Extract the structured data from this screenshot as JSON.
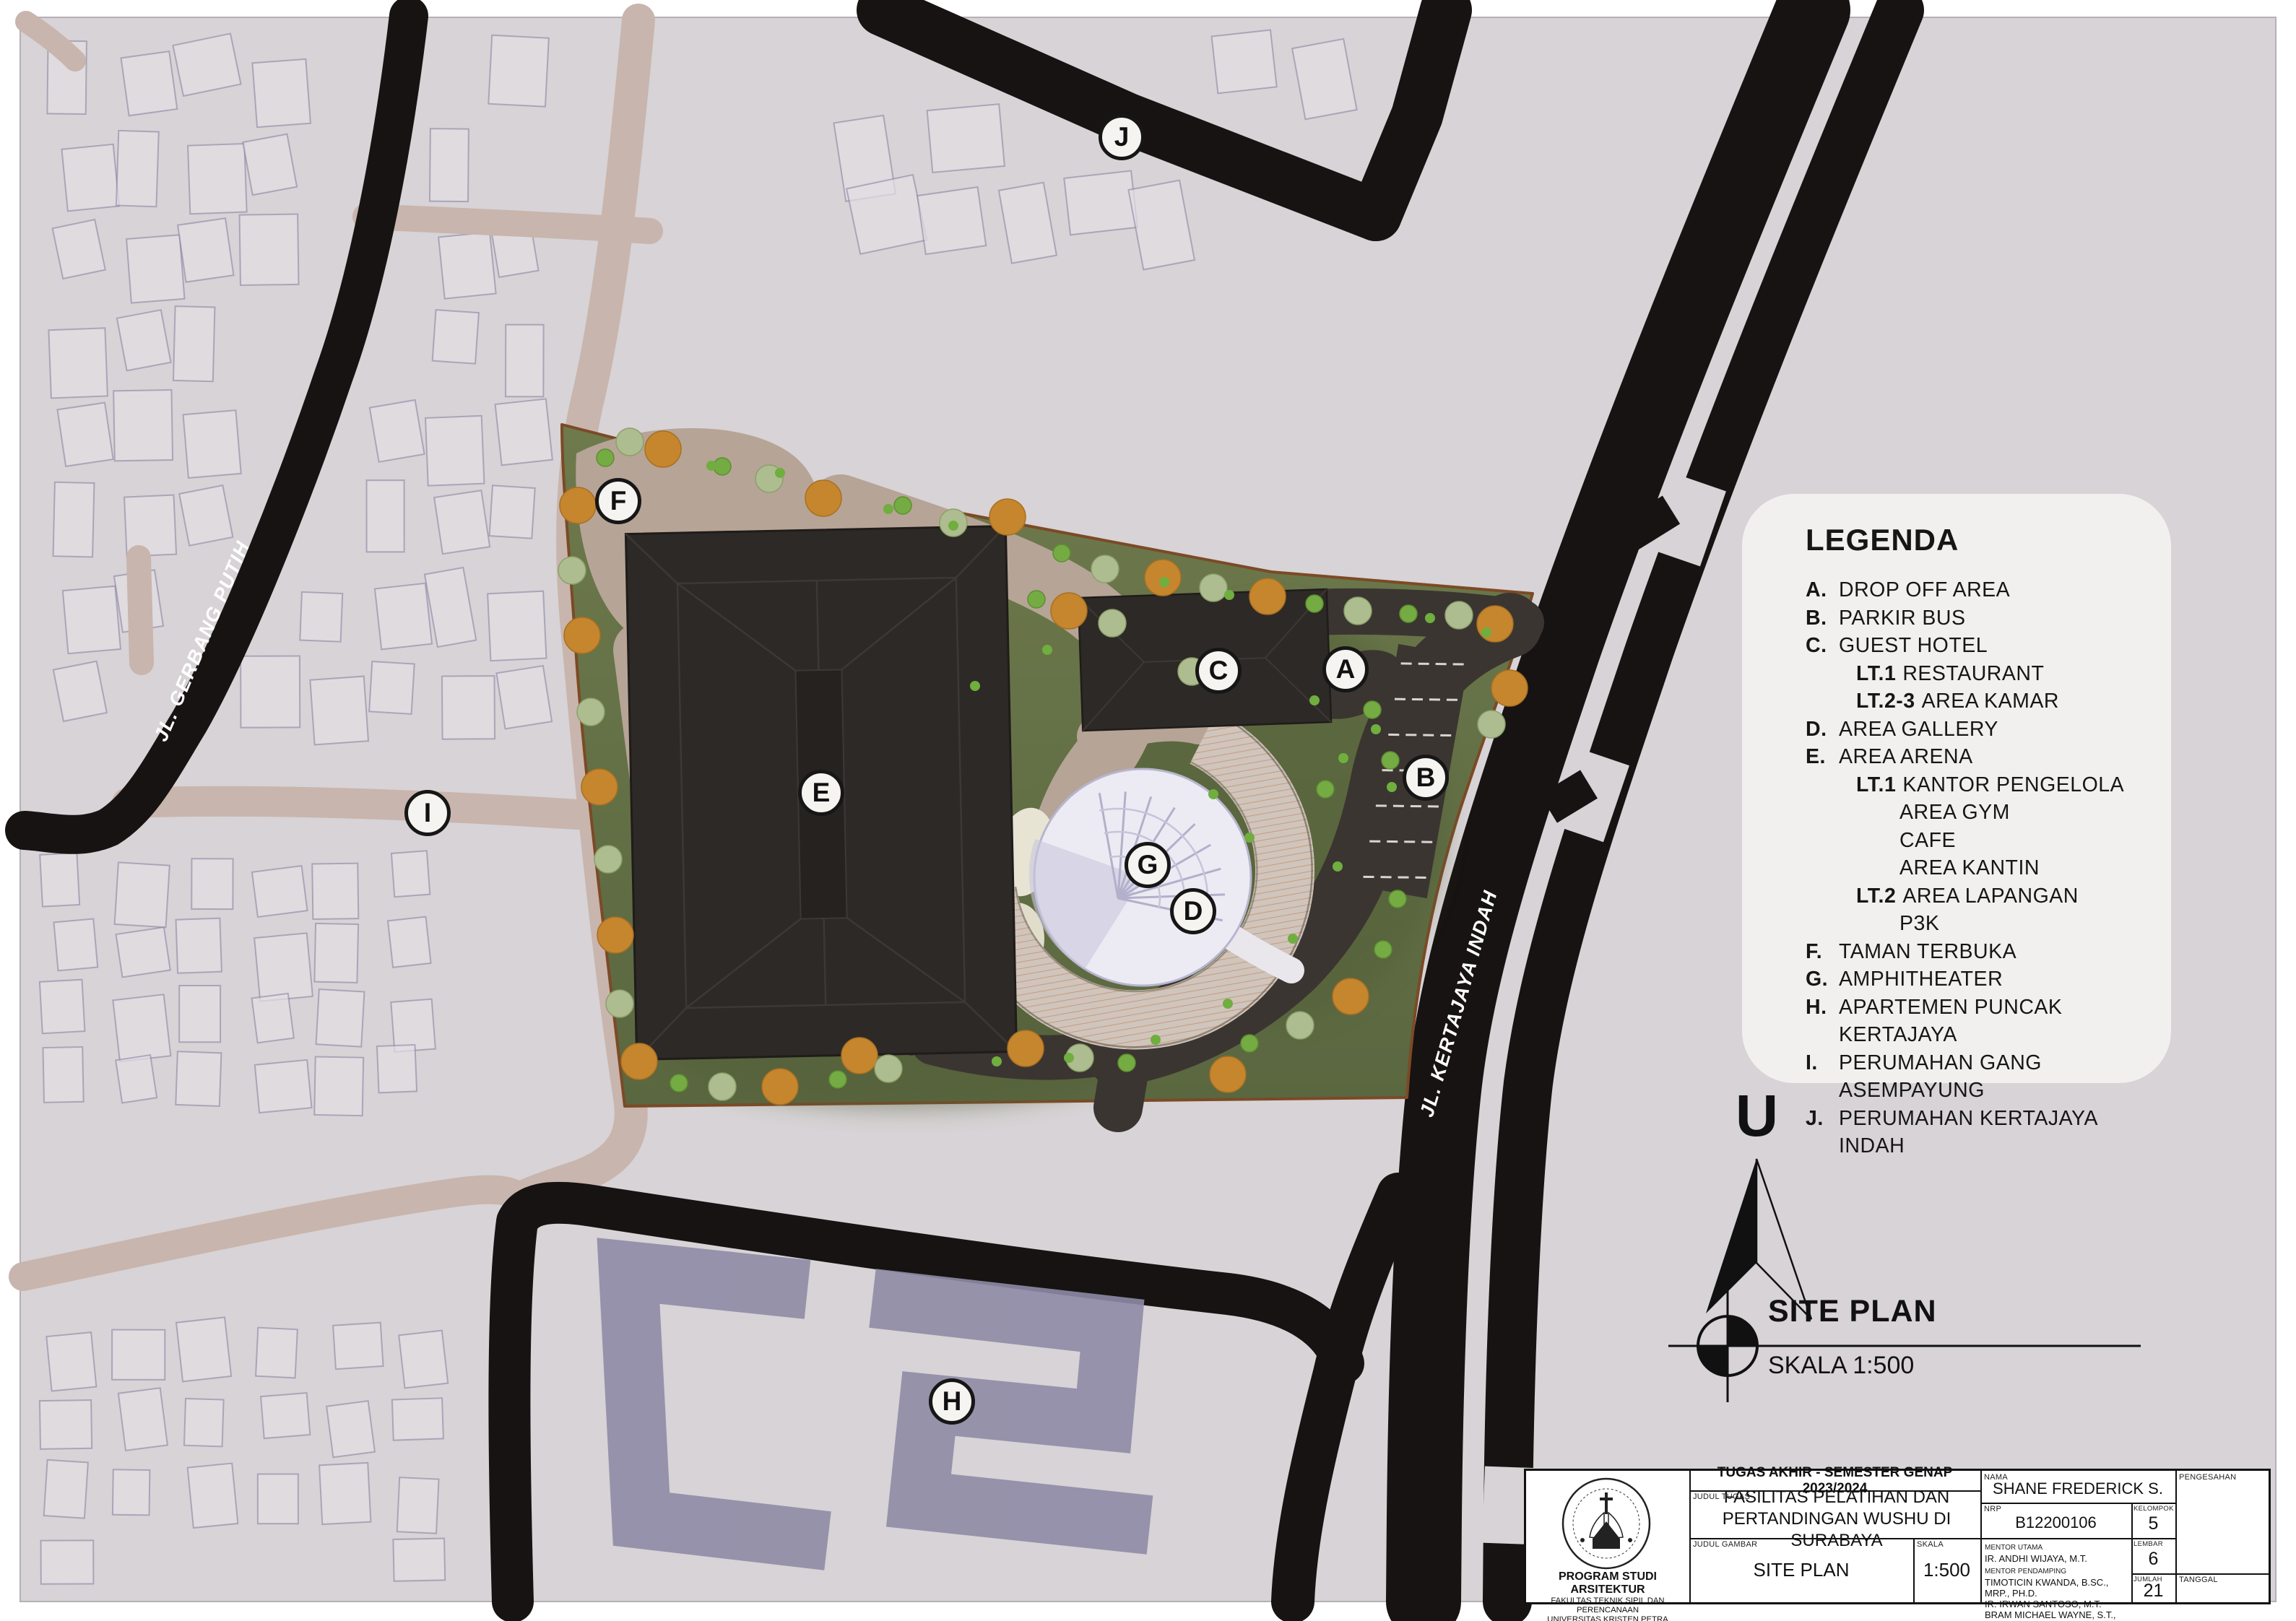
{
  "map": {
    "labels": [
      {
        "letter": "A"
      },
      {
        "letter": "B"
      },
      {
        "letter": "C"
      },
      {
        "letter": "D"
      },
      {
        "letter": "E"
      },
      {
        "letter": "F"
      },
      {
        "letter": "G"
      },
      {
        "letter": "H"
      },
      {
        "letter": "I"
      },
      {
        "letter": "J"
      }
    ],
    "roads": {
      "gerbang_putih": "JL. GERBANG PUTIH",
      "kertajaya_indah": "JL. KERTAJAYA INDAH"
    }
  },
  "north_label": "U",
  "siteplan": {
    "title": "SITE PLAN",
    "scale": "SKALA 1:500"
  },
  "legend": {
    "title": "LEGENDA",
    "items": [
      {
        "letter": "A.",
        "prefix": "",
        "text": "DROP OFF AREA"
      },
      {
        "letter": "B.",
        "prefix": "",
        "text": "PARKIR BUS"
      },
      {
        "letter": "C.",
        "prefix": "",
        "text": "GUEST HOTEL"
      },
      {
        "letter": "",
        "prefix": "LT.1",
        "text": "RESTAURANT"
      },
      {
        "letter": "",
        "prefix": "LT.2-3",
        "text": "AREA KAMAR"
      },
      {
        "letter": "D.",
        "prefix": "",
        "text": "AREA GALLERY"
      },
      {
        "letter": "E.",
        "prefix": "",
        "text": "AREA ARENA"
      },
      {
        "letter": "",
        "prefix": "LT.1",
        "text": "KANTOR PENGELOLA"
      },
      {
        "letter": "",
        "prefix": "",
        "text": "AREA GYM"
      },
      {
        "letter": "",
        "prefix": "",
        "text": "CAFE"
      },
      {
        "letter": "",
        "prefix": "",
        "text": "AREA KANTIN"
      },
      {
        "letter": "",
        "prefix": "LT.2",
        "text": "AREA LAPANGAN"
      },
      {
        "letter": "",
        "prefix": "",
        "text": "P3K"
      },
      {
        "letter": "F.",
        "prefix": "",
        "text": "TAMAN TERBUKA"
      },
      {
        "letter": "G.",
        "prefix": "",
        "text": "AMPHITHEATER"
      },
      {
        "letter": "H.",
        "prefix": "",
        "text": "APARTEMEN PUNCAK KERTAJAYA"
      },
      {
        "letter": "I.",
        "prefix": "",
        "text": "PERUMAHAN GANG ASEMPAYUNG"
      },
      {
        "letter": "J.",
        "prefix": "",
        "text": "PERUMAHAN KERTAJAYA INDAH"
      }
    ]
  },
  "titleblock": {
    "project_header": "TUGAS AKHIR - SEMESTER GENAP 2023/2024",
    "judul_tugas_label": "JUDUL TUGAS",
    "judul_tugas": "FASILITAS PELATIHAN DAN PERTANDINGAN WUSHU DI SURABAYA",
    "judul_gambar_label": "JUDUL GAMBAR",
    "judul_gambar": "SITE PLAN",
    "skala_label": "SKALA",
    "skala": "1:500",
    "nama_label": "NAMA",
    "nama": "SHANE FREDERICK S.",
    "nrp_label": "NRP",
    "nrp": "B12200106",
    "kelompok_label": "KELOMPOK",
    "kelompok": "5",
    "mentor_utama_label": "MENTOR UTAMA",
    "mentor_utama": "IR. ANDHI WIJAYA, M.T.",
    "mentor_pendamping_label": "MENTOR PENDAMPING",
    "mentor_pendamping": [
      "TIMOTICIN KWANDA, B.SC., MRP., PH.D.",
      "IR. IRWAN SANTOSO, M.T.",
      "BRAM MICHAEL WAYNE, S.T., M.ARS."
    ],
    "lembar_label": "LEMBAR",
    "lembar": "6",
    "jumlah_label": "JUMLAH",
    "jumlah": "21",
    "pengesahan_label": "PENGESAHAN",
    "tanggal_label": "TANGGAL",
    "institution": {
      "line1": "PROGRAM STUDI ARSITEKTUR",
      "line2": "FAKULTAS TEKNIK SIPIL DAN PERENCANAAN",
      "line3": "UNIVERSITAS KRISTEN PETRA",
      "line4": "SURABAYA"
    }
  }
}
